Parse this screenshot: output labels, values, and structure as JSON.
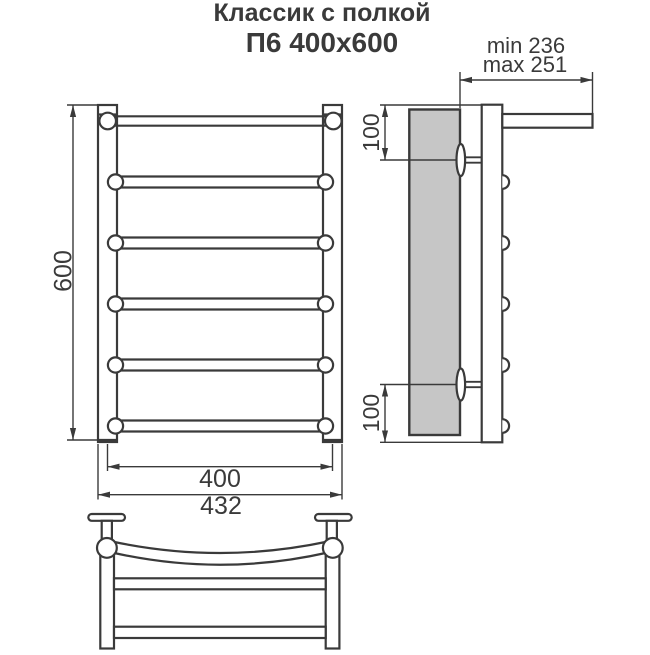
{
  "title": {
    "line1": "Классик с полкой",
    "line2": "П6 400x600"
  },
  "views": {
    "front": {
      "dim_height": "600",
      "dim_bar_width": "400",
      "dim_overall_width": "432"
    },
    "side": {
      "dim_depth_min": "min 236",
      "dim_depth_max": "max 251",
      "dim_top_mount": "100",
      "dim_bottom_mount": "100"
    }
  },
  "colors": {
    "line": "#3a3a3a",
    "wall_fill": "#c6c6c6",
    "background": "#ffffff"
  }
}
